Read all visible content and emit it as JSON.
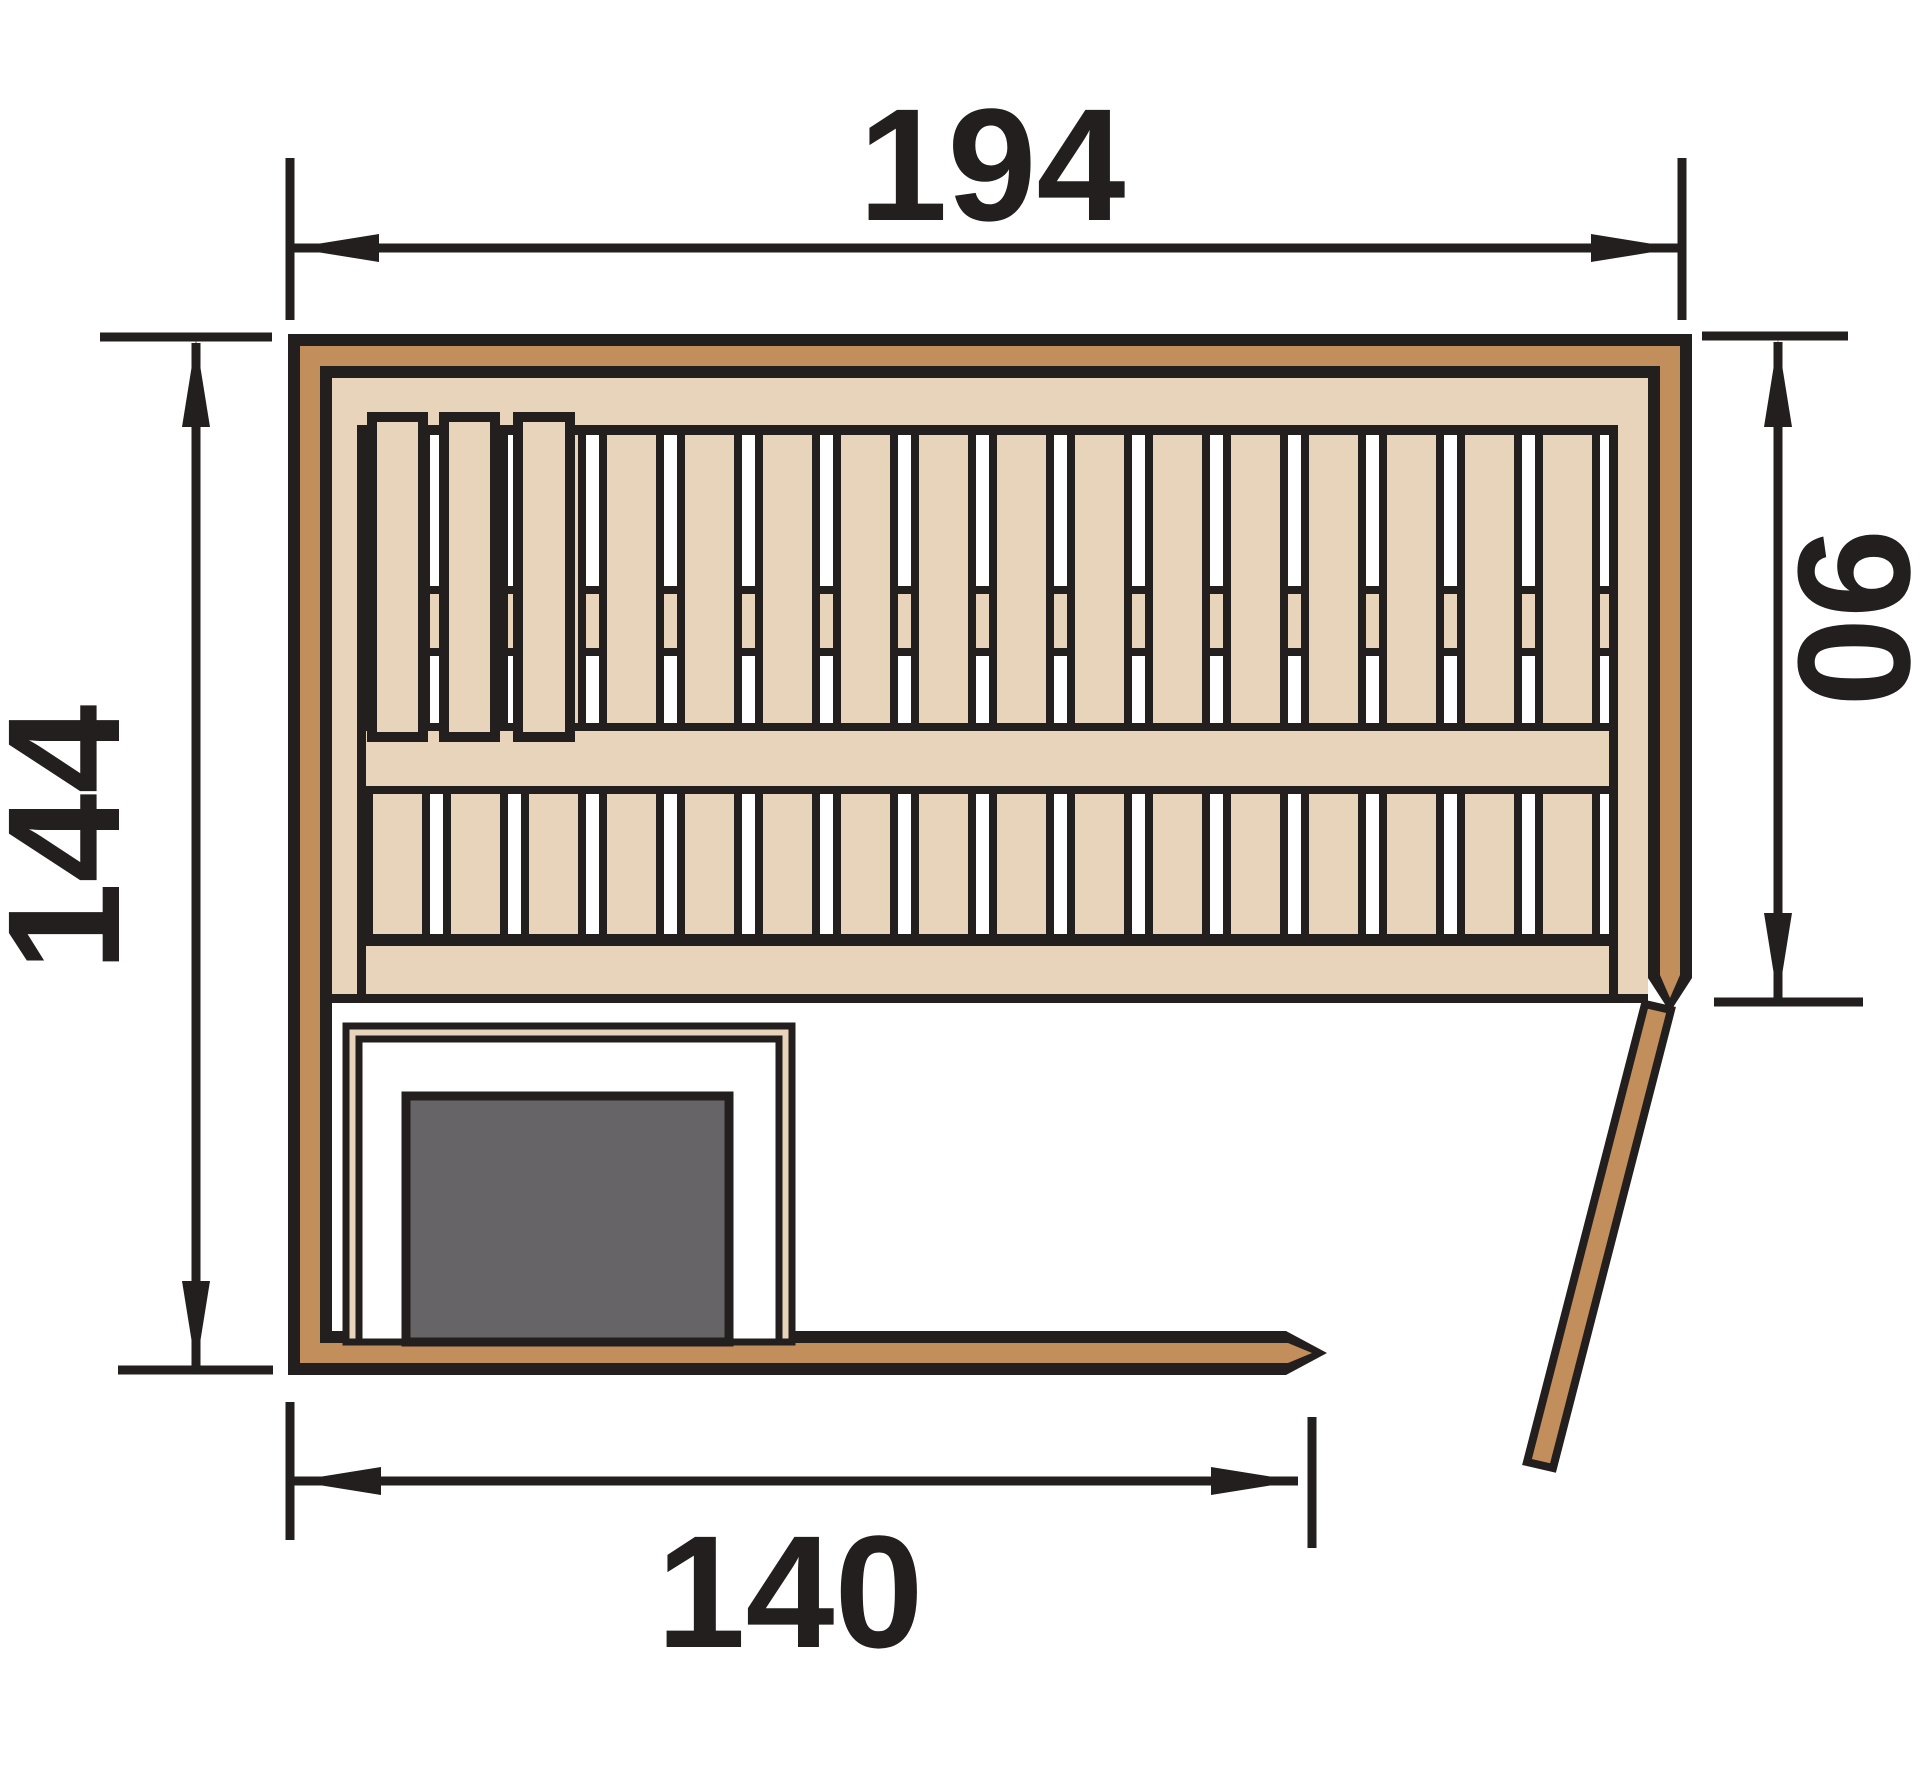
{
  "drawing": {
    "kind": "sauna-floor-plan",
    "dims": {
      "top": {
        "value": "194",
        "meaning": "outer-width"
      },
      "left": {
        "value": "144",
        "meaning": "outer-depth"
      },
      "right": {
        "value": "90",
        "meaning": "right-wall-segment-to-door"
      },
      "bottom": {
        "value": "140",
        "meaning": "front-wall-segment-to-door"
      }
    }
  },
  "colors": {
    "c-line": "#221f1e",
    "c-wood": "#c28e5c",
    "c-panel": "#e7d4ba",
    "c-heater": "#666467"
  }
}
